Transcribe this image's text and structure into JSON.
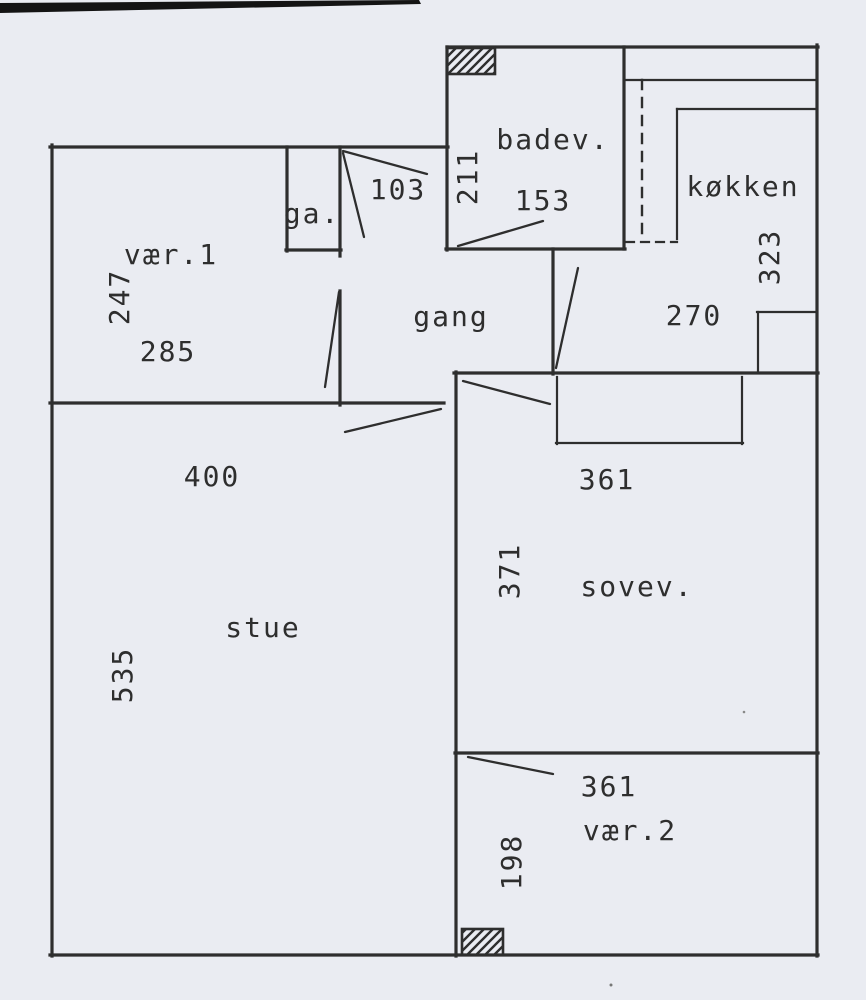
{
  "document": {
    "kind": "scanned floor plan",
    "language": "danish"
  },
  "colors": {
    "paper": "#eaecf2",
    "ink": "#2e2e2e",
    "scan_edge": "#141414"
  },
  "rooms": {
    "vaer1": {
      "label": "vær.1",
      "dim_height": "247",
      "dim_width": "285"
    },
    "garderobe": {
      "label": "ga."
    },
    "gang": {
      "label": "gang",
      "dim_door": "103",
      "dim_width": "270"
    },
    "badevaerelse": {
      "label": "badev.",
      "dim_height": "211",
      "dim_door": "153"
    },
    "koekken": {
      "label": "køkken",
      "dim_height": "323"
    },
    "stue": {
      "label": "stue",
      "dim_width": "400",
      "dim_height": "535"
    },
    "sovevaerelse": {
      "label": "sovev.",
      "dim_width": "361",
      "dim_height": "371"
    },
    "vaer2": {
      "label": "vær.2",
      "dim_width": "361",
      "dim_height": "198"
    }
  }
}
